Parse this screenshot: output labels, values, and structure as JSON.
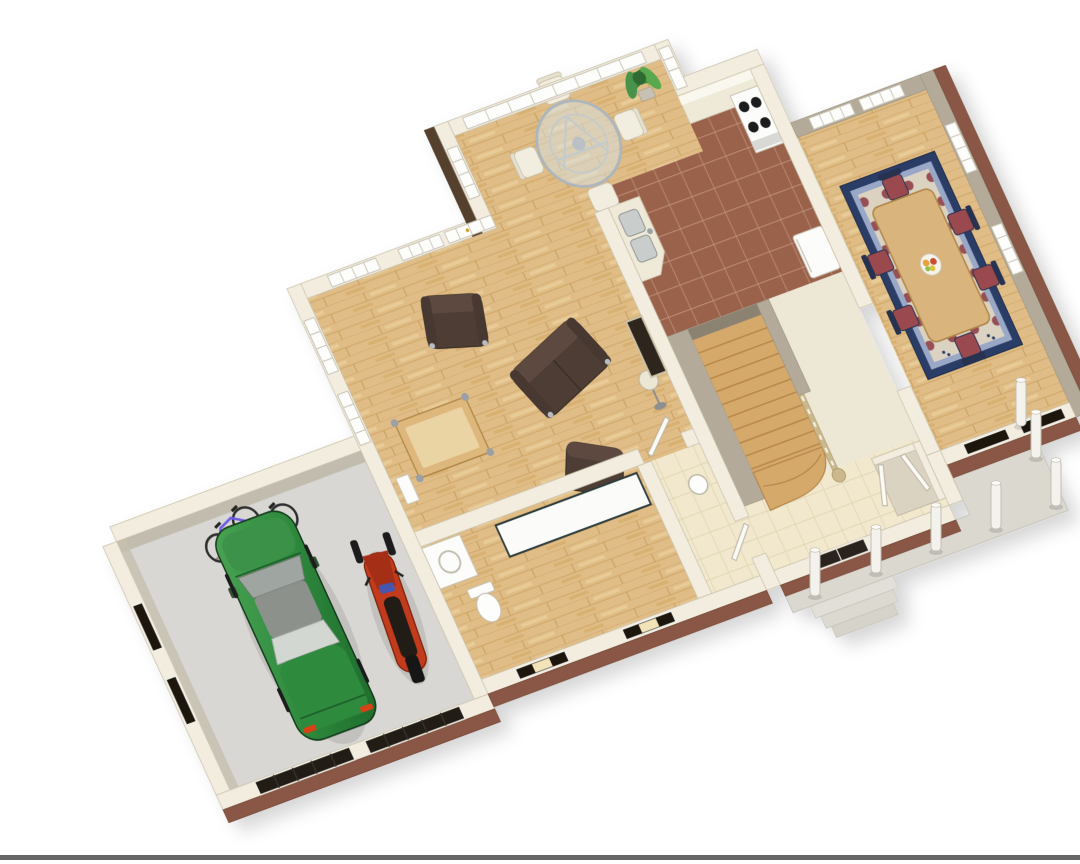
{
  "scene": {
    "type": "3d-floor-plan-rendering",
    "description": "Isometric 3D rendering of a house first-floor plan with cut-away cream walls, brick front facade, covered porch with round columns, and an attached garage containing a green car, a red snowmobile and two bicycles",
    "background": "#FFFFFF"
  },
  "rooms": [
    {
      "name": "garage",
      "floor": "gray concrete",
      "contents": [
        "green car",
        "red snowmobile",
        "purple bicycle",
        "orange bicycle",
        "bike rack",
        "two garage doors",
        "two side windows"
      ]
    },
    {
      "name": "living-room",
      "floor": "hardwood",
      "contents": [
        "brown leather loveseat",
        "brown leather armchair",
        "brown leather chair",
        "wood coffee table",
        "floor lamp",
        "fireplace",
        "windows",
        "french-door"
      ]
    },
    {
      "name": "breakfast-nook",
      "floor": "hardwood",
      "contents": [
        "round glass table",
        "four metal chairs",
        "potted plant",
        "floor-to-ceiling windows"
      ]
    },
    {
      "name": "kitchen",
      "floor": "brown tile",
      "contents": [
        "range with four burners",
        "double stainless sink",
        "refrigerator",
        "back counter"
      ]
    },
    {
      "name": "dining-room",
      "floor": "hardwood",
      "contents": [
        "wood dining table",
        "six chairs with maroon cushions",
        "navy-bordered area rug",
        "fruit bowl",
        "windows"
      ]
    },
    {
      "name": "stair-hall",
      "floor": "hardwood treads",
      "contents": [
        "staircase with curved bottom steps",
        "railing with balusters"
      ]
    },
    {
      "name": "laundry-bathroom",
      "floor": "hardwood and beige tile",
      "contents": [
        "counter",
        "washer",
        "toilet",
        "pedestal sink",
        "doors"
      ]
    },
    {
      "name": "foyer",
      "floor": "beige tile",
      "contents": [
        "closet with white double doors",
        "dark paneled front door"
      ]
    },
    {
      "name": "porch",
      "floor": "concrete slab",
      "contents": [
        "seven round columns",
        "entry steps"
      ]
    }
  ],
  "vehicles": {
    "car_color": "#2F8A3D",
    "snowmobile_color": "#C23A1C",
    "bicycle_colors": [
      "#6C5CE7",
      "#E17030"
    ]
  },
  "palette": {
    "background": "#FFFFFF",
    "wall_cream": "#F2EDDF",
    "wall_taupe": "#B3AA99",
    "brick": "#8A5644",
    "wood_floor": "#E0BD86",
    "kitchen_tile": "#9A624C",
    "foyer_tile": "#F1E8CD",
    "garage_floor": "#D8D7D3",
    "porch_slab": "#DBD8D0",
    "rug_border_navy": "#2B3D66",
    "dining_chair_maroon": "#9A4850",
    "sofa_brown": "#4E3E35",
    "stair_wood": "#D4A96B",
    "baseline_strip": "#575757"
  }
}
